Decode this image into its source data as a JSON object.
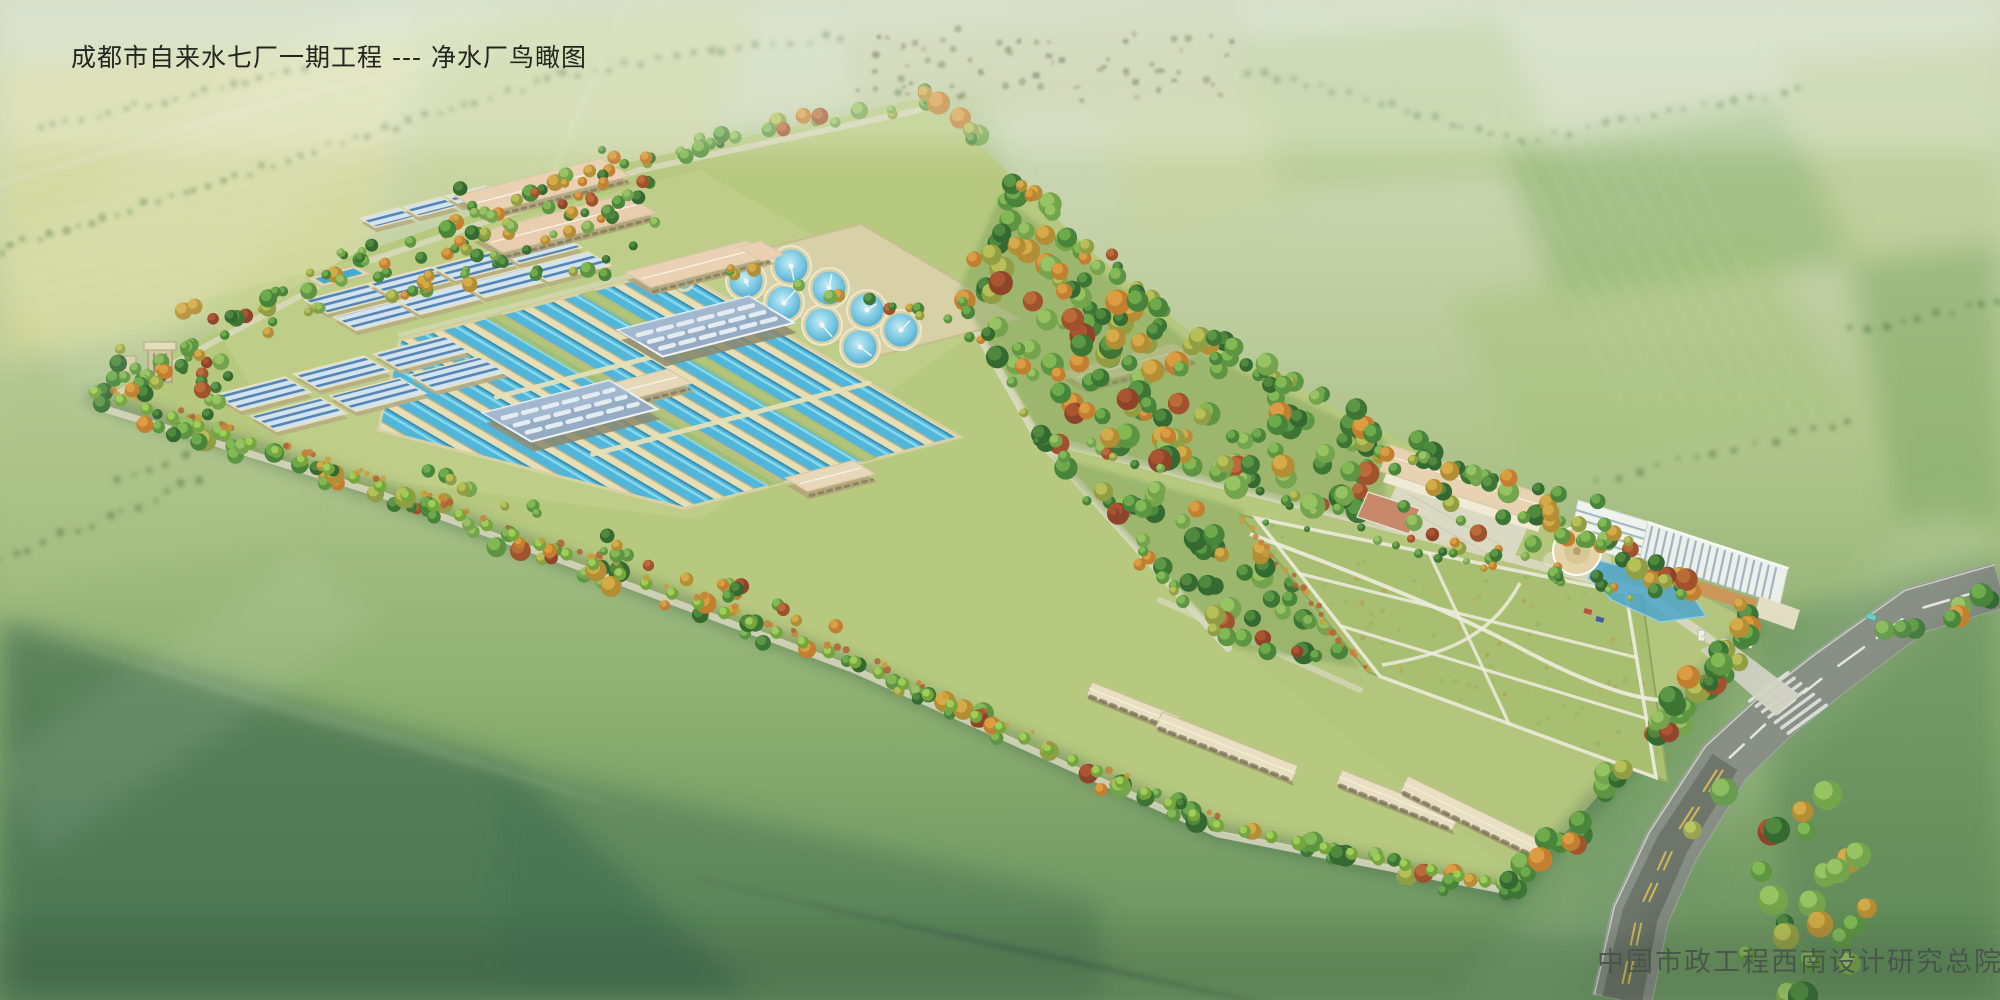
{
  "page": {
    "title_text": "成都市自来水七厂一期工程 --- 净水厂鸟瞰图",
    "credit_text": "中国市政工程西南设计研究总院"
  },
  "scene": {
    "description": "Aerial perspective rendering (bird's-eye view) of the Chengdu No.7 waterworks Phase-I water purification plant, a long tree-belted site set in hazy patchwork farmland",
    "elements": [
      {
        "name": "sedimentation-channels",
        "label": "long open sedimentation and filtration channels with blue water"
      },
      {
        "name": "covered-filter-tanks",
        "label": "rows of covered filter tanks with blue slatted covers"
      },
      {
        "name": "circular-clarifiers",
        "label": "eight circular clarifier tanks on a concrete deck"
      },
      {
        "name": "filter-house",
        "label": "blue metal-roofed filter houses with white skylight bands"
      },
      {
        "name": "workshop-buildings",
        "label": "beige workshop and dosing buildings with pink-beige roofs"
      },
      {
        "name": "administration-buildings",
        "label": "administration and laboratory buildings with entrance court and red sports court"
      },
      {
        "name": "round-pavilion",
        "label": "round pavilion beside an ornamental pond"
      },
      {
        "name": "central-grove",
        "label": "dense landscaped grove with green and autumn trees"
      },
      {
        "name": "great-lawn",
        "label": "large lawn with white curved and rectangular paths"
      },
      {
        "name": "garage-buildings",
        "label": "garage and maintenance buildings near the south corner"
      },
      {
        "name": "water-tower",
        "label": "small water tower at the west tip of the site"
      },
      {
        "name": "perimeter-tree-belt",
        "label": "tree belt and hedge around the site boundary"
      },
      {
        "name": "access-road",
        "label": "main road with junction, zebra crossing and entrance gate"
      },
      {
        "name": "farmland-background",
        "label": "hazy green and yellow farmland with hedgerows and a distant village"
      }
    ]
  },
  "palette": {
    "water": "#4ab4dc",
    "water_light": "#90e0f2",
    "water_deep": "#2f8cb4",
    "tank_wall": "#e7dfb6",
    "deck": "#d9cfa6",
    "roof_pink": "#ecd0b4",
    "wall_beige": "#cbbf92",
    "roof_blue": "#92a9c4",
    "skylight": "#e9eff5",
    "white_building": "#f1f4f0",
    "site_grass": "#b6c77c",
    "lawn": "#a6bd6d",
    "road_inner": "#dcd8c2",
    "road_main": "#7b8279",
    "road_dark": "#596057",
    "lane_yellow": "#d9b945",
    "canopy_orange": "#cd9050",
    "court_red": "#c78466",
    "title_color": "#24251f",
    "credit_color": "#49544b"
  }
}
